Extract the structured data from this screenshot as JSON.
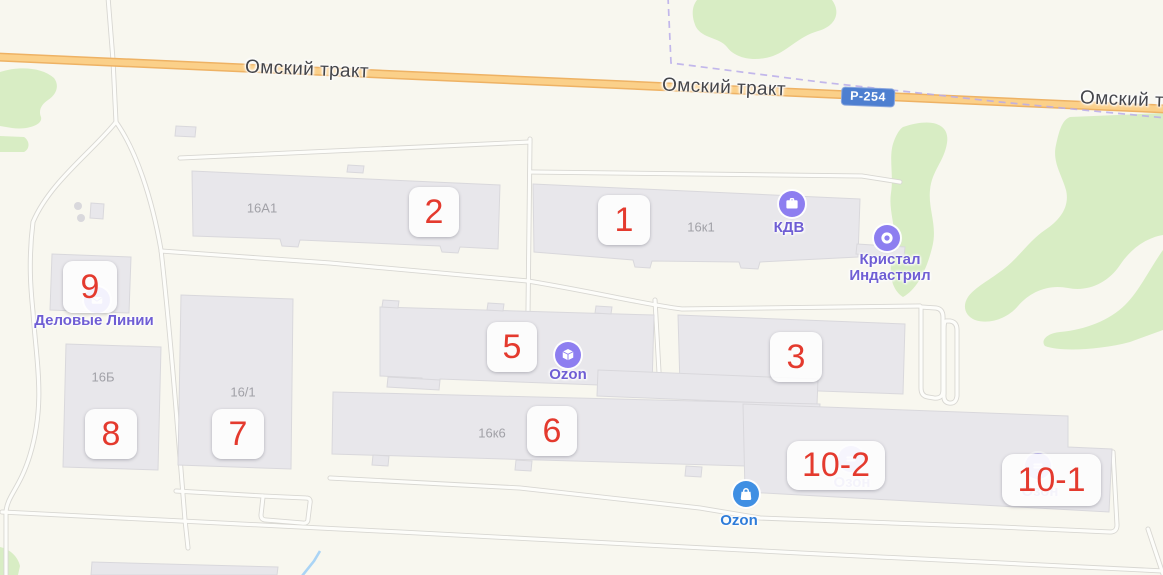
{
  "road_labels": [
    {
      "text": "Омский тракт"
    },
    {
      "text": "Омский тракт"
    },
    {
      "text": "Омский т"
    }
  ],
  "route_shield": {
    "text": "Р-254"
  },
  "markers": [
    {
      "label": "2"
    },
    {
      "label": "1"
    },
    {
      "label": "9"
    },
    {
      "label": "5"
    },
    {
      "label": "3"
    },
    {
      "label": "6"
    },
    {
      "label": "8"
    },
    {
      "label": "7"
    },
    {
      "label": "10-2"
    },
    {
      "label": "10-1"
    }
  ],
  "addresses": [
    {
      "text": "16А1"
    },
    {
      "text": "16к1"
    },
    {
      "text": "16Б"
    },
    {
      "text": "16/1"
    },
    {
      "text": "16к6"
    }
  ],
  "pois": [
    {
      "label": "КДВ"
    },
    {
      "label": "Кристал Индастрил"
    },
    {
      "label": "Ozon"
    },
    {
      "label": "Деловые Линии"
    },
    {
      "label": "Ozon"
    },
    {
      "label": "Озон"
    },
    {
      "label": "Озон"
    }
  ],
  "colors": {
    "background": "#f8f7ef",
    "building": "#e8e7eb",
    "green": "#d8edc4",
    "highway_casing": "#eeb264",
    "highway_fill": "#fbd089",
    "marker_number": "#e43a2e",
    "poi_purple_circle": "#8d7ef0",
    "poi_purple_text": "#6f5ed4",
    "poi_blue_circle": "#3f8fe3",
    "poi_blue_text": "#2e7cd9",
    "boundary": "#b8abea",
    "water": "#aad4f5"
  }
}
